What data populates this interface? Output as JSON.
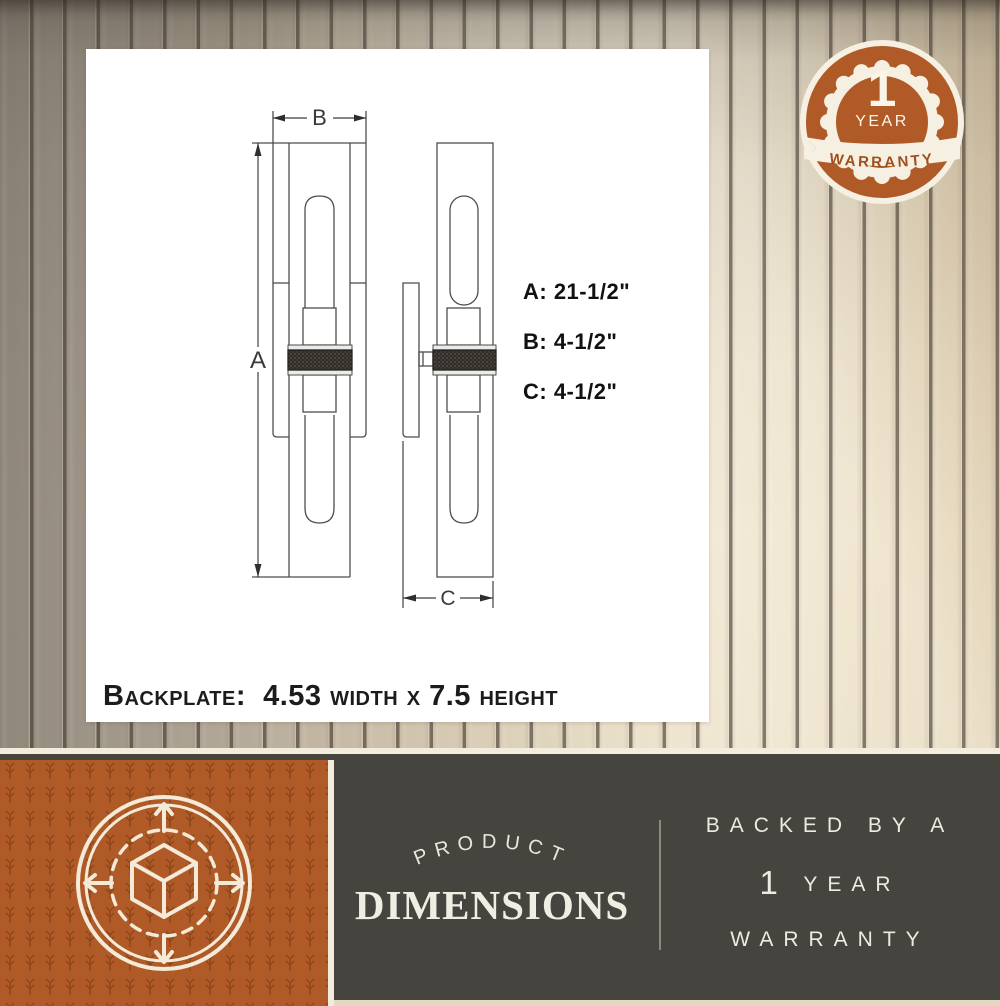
{
  "card": {
    "dim_letters": {
      "a": "A",
      "b": "B",
      "c": "C"
    },
    "dims": [
      {
        "label": "A: 21-1/2\""
      },
      {
        "label": "B: 4-1/2\""
      },
      {
        "label": "C: 4-1/2\""
      }
    ],
    "backplate_note": "Backplate:  4.53 width x 7.5 height"
  },
  "badge": {
    "number": "1",
    "unit": "YEAR",
    "ribbon": "WARRANTY"
  },
  "footer": {
    "arc_label": "PRODUCT",
    "title": "DIMENSIONS",
    "line1": "BACKED BY A",
    "line2_number": "1",
    "line2_unit": "YEAR",
    "line3": "WARRANTY"
  },
  "colors": {
    "accent_orange": "#b05a28",
    "pattern_orange_dark": "#7f3d12",
    "panel_gray": "#45443e",
    "cream": "#f3ecdc",
    "wood_light": "#e6dcc6",
    "wood_dark": "#8f867a"
  }
}
